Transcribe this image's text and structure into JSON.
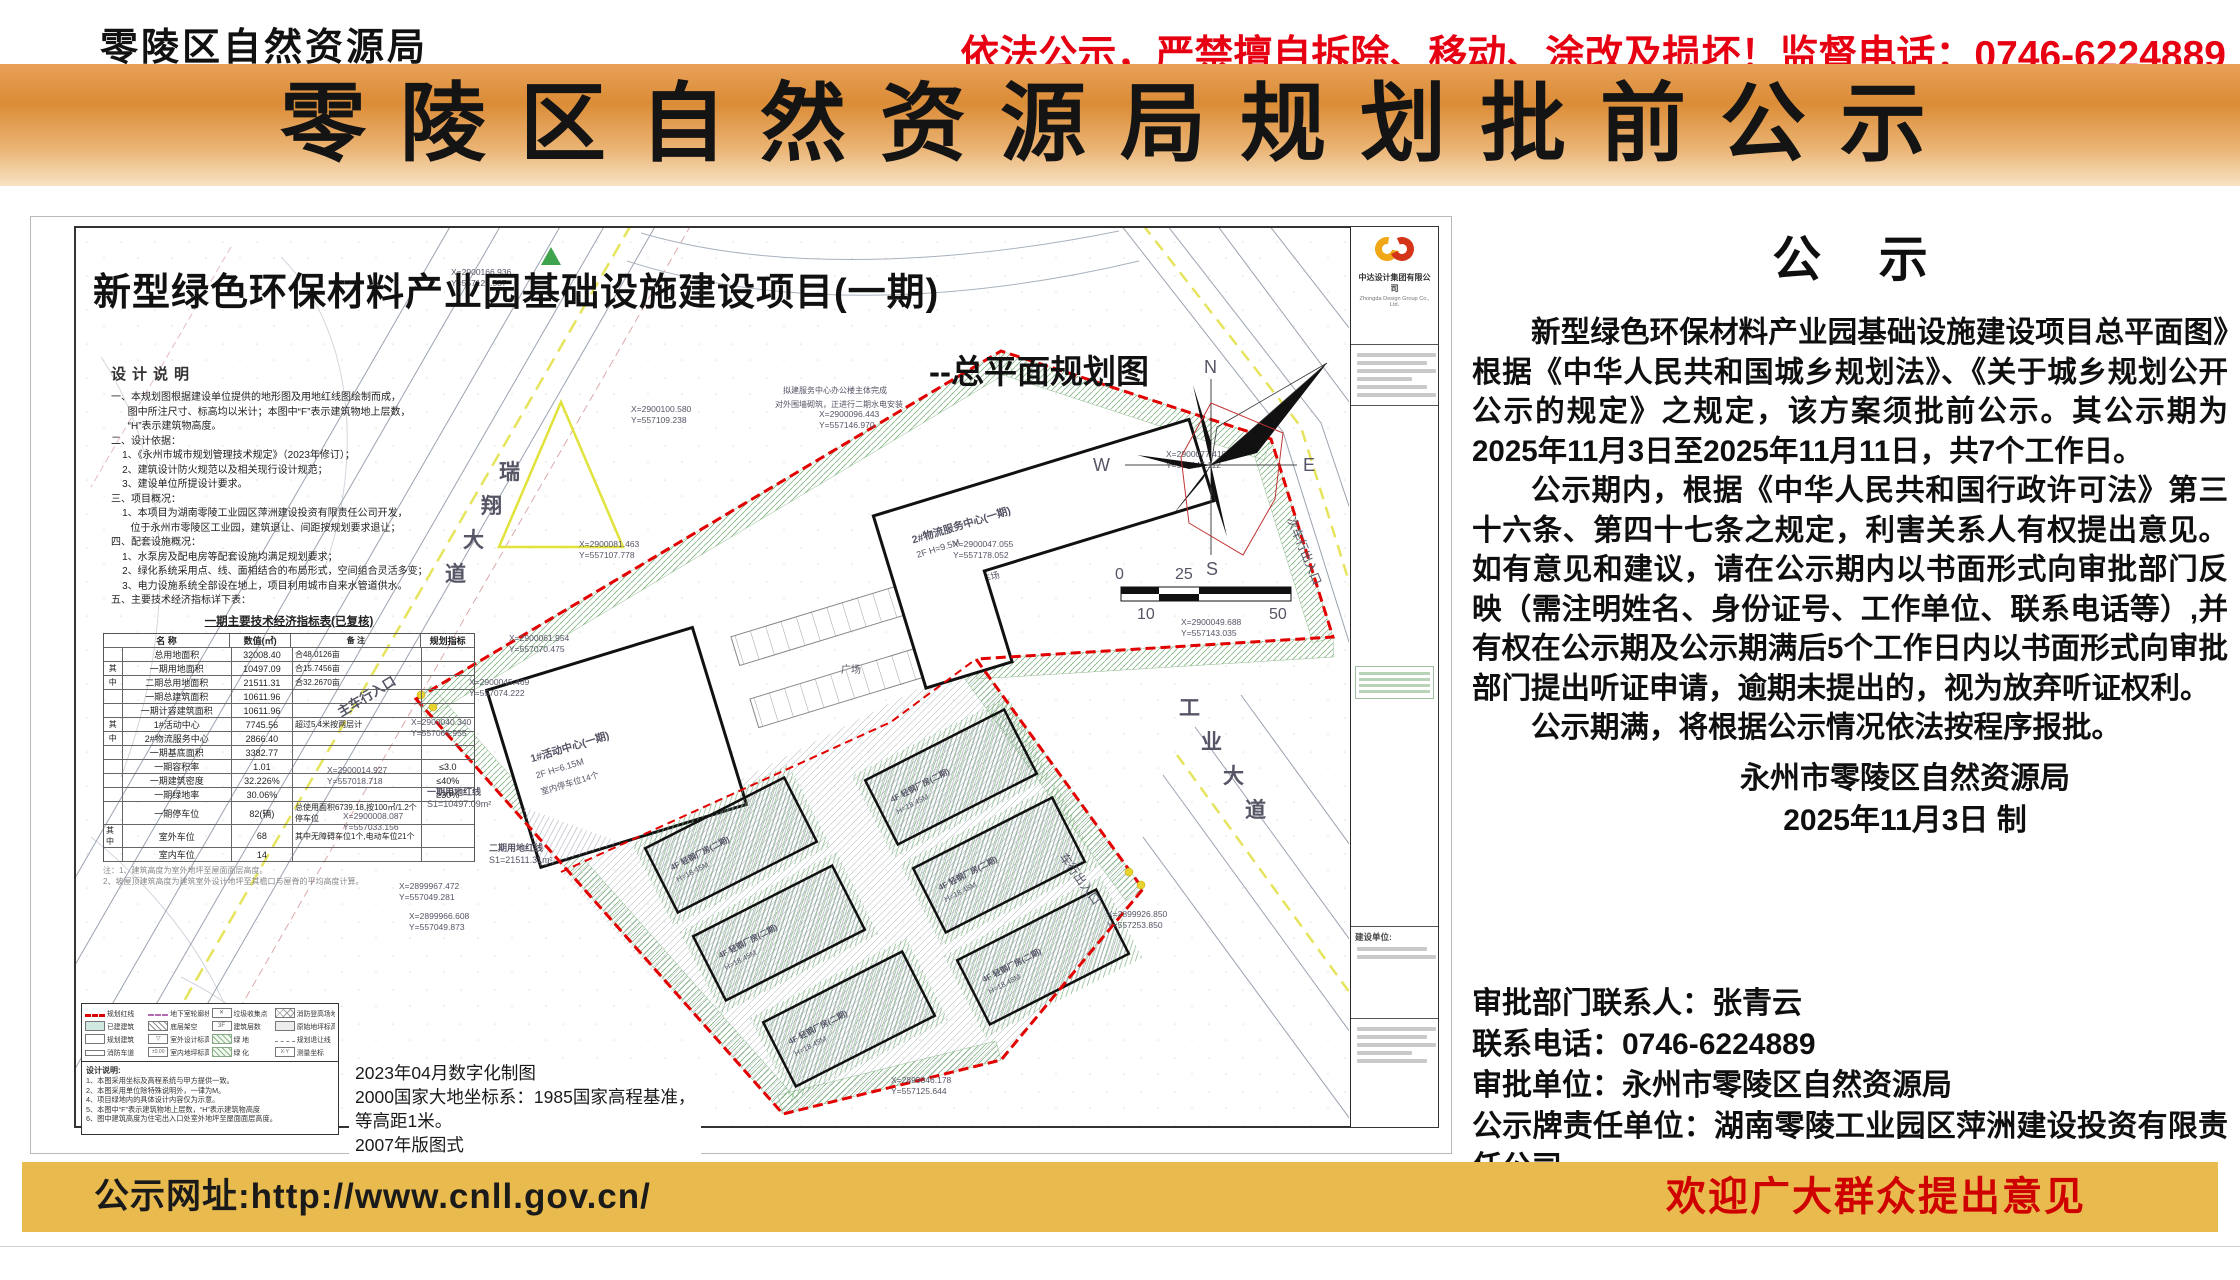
{
  "header": {
    "org_cn": "零陵区自然资源局",
    "org_en": "Lingling District Natural Resources Bureau",
    "warning": "依法公示，严禁擅自拆除、移动、涂改及损坏！监督电话：0746-6224889"
  },
  "banner": {
    "title": "零陵区自然资源局规划批前公示"
  },
  "map": {
    "title": "新型绿色环保材料产业园基础设施建设项目(一期)",
    "subtitle": "--总平面规划图",
    "compass": {
      "n": "N",
      "e": "E",
      "s": "S",
      "w": "W"
    },
    "scale": {
      "zero": "0",
      "twentyfive": "25",
      "ten": "10",
      "fifty": "50"
    },
    "roads": {
      "left": [
        "瑞",
        "翔",
        "大",
        "道"
      ],
      "right": [
        "工",
        "业",
        "大",
        "道"
      ]
    },
    "entrances": {
      "main": "主车行入口",
      "side": "车行出入口",
      "second": "次车行出入口"
    },
    "plaza": "广场",
    "site_note1": "拟建服务中心办公楼主体完成",
    "site_note2": "对外围墙砌筑，正进行二期水电安装",
    "phase1_line1": "一期用地红线",
    "phase1_line2": "S1=10497.09m²",
    "phase2_line1": "二期用地红线",
    "phase2_line2": "S1=21511.31m²",
    "b1": [
      "1#活动中心(一期)",
      "2F  H=6.15M",
      "室内停车位14个"
    ],
    "b2": [
      "2#物流服务中心(一期)",
      "2F  H=9.5M"
    ],
    "parking_label": "停车场",
    "p2b": [
      "4F 轻钢厂房(二期)",
      "H=18.45M"
    ],
    "coords": [
      {
        "x": "X=2900166.936",
        "y": "Y=557128.587"
      },
      {
        "x": "X=2900100.580",
        "y": "Y=557109.238"
      },
      {
        "x": "X=2900096.443",
        "y": "Y=557146.970"
      },
      {
        "x": "X=2900077.410",
        "y": "Y=557147.112"
      },
      {
        "x": "X=2900081.463",
        "y": "Y=557107.778"
      },
      {
        "x": "X=2900061.954",
        "y": "Y=557070.475"
      },
      {
        "x": "X=2900045.469",
        "y": "Y=557074.222"
      },
      {
        "x": "X=2900040.340",
        "y": "Y=557065.955"
      },
      {
        "x": "X=2900014.927",
        "y": "Y=557018.718"
      },
      {
        "x": "X=2900008.087",
        "y": "Y=557033.156"
      },
      {
        "x": "X=2899967.472",
        "y": "Y=557049.281"
      },
      {
        "x": "X=2899966.608",
        "y": "Y=557049.873"
      },
      {
        "x": "X=2899846.178",
        "y": "Y=557125.644"
      },
      {
        "x": "X=2900047.055",
        "y": "Y=557178.052"
      },
      {
        "x": "X=2899926.850",
        "y": "Y=557253.850"
      },
      {
        "x": "X=2900049.688",
        "y": "Y=557143.035"
      }
    ],
    "design_notes": {
      "title": "设计说明",
      "lines": [
        "一、本规划图根据建设单位提供的地形图及用地红线图绘制而成，",
        "      图中所注尺寸、标高均以米计；本图中“F”表示建筑物地上层数，",
        "      “H”表示建筑物高度。",
        "二、设计依据：",
        "    1、《永州市城市规划管理技术规定》（2023年修订）；",
        "    2、建筑设计防火规范以及相关现行设计规范；",
        "    3、建设单位所提设计要求。",
        "三、项目概况：",
        "    1、本项目为湖南零陵工业园区萍洲建设投资有限责任公司开发，",
        "       位于永州市零陵区工业园，建筑退让、间距按规划要求退让；",
        "四、配套设施概况：",
        "    1、水泵房及配电房等配套设施均满足规划要求；",
        "    2、绿化系统采用点、线、面相结合的布局形式，空间组合灵活多变；",
        "    3、电力设施系统全部设在地上，项目利用城市自来水管道供水。",
        "五、主要技术经济指标详下表："
      ]
    },
    "table": {
      "title": "一期主要技术经济指标表(已复核)",
      "headers": [
        "名  称",
        "数值(㎡)",
        "备  注",
        "规划指标"
      ],
      "rows": [
        {
          "g": "",
          "n": "总用地面积",
          "v": "32008.40",
          "b": "合48.0126亩",
          "i": ""
        },
        {
          "g": "其",
          "n": "一期用地面积",
          "v": "10497.09",
          "b": "合15.7456亩",
          "i": ""
        },
        {
          "g": "中",
          "n": "二期总用地面积",
          "v": "21511.31",
          "b": "合32.2670亩",
          "i": ""
        },
        {
          "g": "",
          "n": "一期总建筑面积",
          "v": "10611.96",
          "b": "",
          "i": ""
        },
        {
          "g": "",
          "n": "一期计容建筑面积",
          "v": "10611.96",
          "b": "",
          "i": ""
        },
        {
          "g": "其",
          "n": "1#活动中心",
          "v": "7745.56",
          "b": "超过5.4米按两层计",
          "i": ""
        },
        {
          "g": "中",
          "n": "2#物流服务中心",
          "v": "2866.40",
          "b": "",
          "i": ""
        },
        {
          "g": "",
          "n": "一期基底面积",
          "v": "3382.77",
          "b": "",
          "i": ""
        },
        {
          "g": "",
          "n": "一期容积率",
          "v": "1.01",
          "b": "",
          "i": "≤3.0"
        },
        {
          "g": "",
          "n": "一期建筑密度",
          "v": "32.226%",
          "b": "",
          "i": "≤40%"
        },
        {
          "g": "",
          "n": "一期绿地率",
          "v": "30.06%",
          "b": "",
          "i": "≥30%"
        },
        {
          "g": "",
          "n": "一期停车位",
          "v": "82(辆)",
          "b": "总使用面积6739.18,按100㎡/1.2个停车位",
          "i": ""
        },
        {
          "g": "其中",
          "n": "室外车位",
          "v": "68",
          "b": "其中无障碍车位1个,电动车位21个",
          "i": ""
        },
        {
          "g": "",
          "n": "室内车位",
          "v": "14",
          "b": "",
          "i": ""
        }
      ],
      "notes": [
        "注：1、建筑高度为室外地坪至屋面面层高度。",
        "      2、坡屋顶建筑高度为建筑室外设计地坪至其檐口与屋脊的平均高度计算。"
      ]
    },
    "legend": {
      "items": [
        {
          "sw": "red-dash",
          "label": "规划红线"
        },
        {
          "sw": "purple-dash",
          "label": "地下室轮廓线"
        },
        {
          "sw": "xmark",
          "label": "垃圾收集点"
        },
        {
          "sw": "cross",
          "label": "消防登高场地"
        },
        {
          "sw": "teal",
          "label": "已建建筑"
        },
        {
          "sw": "grayhatch",
          "label": "底层架空"
        },
        {
          "sw": "num",
          "label": "建筑层数"
        },
        {
          "sw": "elev",
          "label": "原始地坪标高"
        },
        {
          "sw": "white",
          "label": "规划建筑"
        },
        {
          "sw": "tri",
          "label": "室外设计标高"
        },
        {
          "sw": "green",
          "label": "绿  地"
        },
        {
          "sw": "setback",
          "label": "规划退让线"
        },
        {
          "sw": "lane",
          "label": "消防车道"
        },
        {
          "sw": "floor",
          "label": "室内地坪标高"
        },
        {
          "sw": "green2",
          "label": "绿  化"
        },
        {
          "sw": "coord",
          "label": "测量坐标"
        }
      ]
    },
    "side_notes": {
      "title": "设计说明:",
      "lines": [
        "1、本图采用坐标及高程系统与甲方提供一致。",
        "2、本图采用单位除特殊说明外，一律为M。",
        "4、项目绿地内的具体设计内容仅为示意。",
        "5、本图中“F”表示建筑物地上层数，“H”表示建筑物高度",
        "6、图中建筑高度为住宅出入口处室外地坪至屋面面层高度。"
      ]
    },
    "survey": [
      "2023年04月数字化制图",
      "2000国家大地坐标系：1985国家高程基准，",
      "等高距1米。",
      "2007年版图式"
    ],
    "title_block": {
      "company_cn": "中达设计集团有限公司",
      "company_en": "Zhongda Design Group Co., Ltd.",
      "client_label": "建设单位:"
    }
  },
  "notice": {
    "heading": "公  示",
    "p1": "新型绿色环保材料产业园基础设施建设项目总平面图》根据《中华人民共和国城乡规划法》、《关于城乡规划公开公示的规定》之规定，该方案须批前公示。其公示期为2025年11月3日至2025年11月11日，共7个工作日。",
    "p2": "公示期内，根据《中华人民共和国行政许可法》第三十六条、第四十七条之规定，利害关系人有权提出意见。如有意见和建议，请在公示期内以书面形式向审批部门反映（需注明姓名、身份证号、工作单位、联系电话等）,并有权在公示期及公示期满后5个工作日内以书面形式向审批部门提出听证申请，逾期未提出的，视为放弃听证权利。",
    "p3": "公示期满，将根据公示情况依法按程序报批。",
    "sig1": "永州市零陵区自然资源局",
    "sig2": "2025年11月3日 制",
    "contacts": [
      "审批部门联系人：张青云",
      "联系电话：0746-6224889",
      "审批单位：永州市零陵区自然资源局",
      "公示牌责任单位：湖南零陵工业园区萍洲建设投资有限责任公司",
      "联系人：贺艳云      联系电话：18907461466"
    ]
  },
  "footer": {
    "url": "公示网址:http://www.cnll.gov.cn/",
    "welcome": "欢迎广大群众提出意见"
  }
}
